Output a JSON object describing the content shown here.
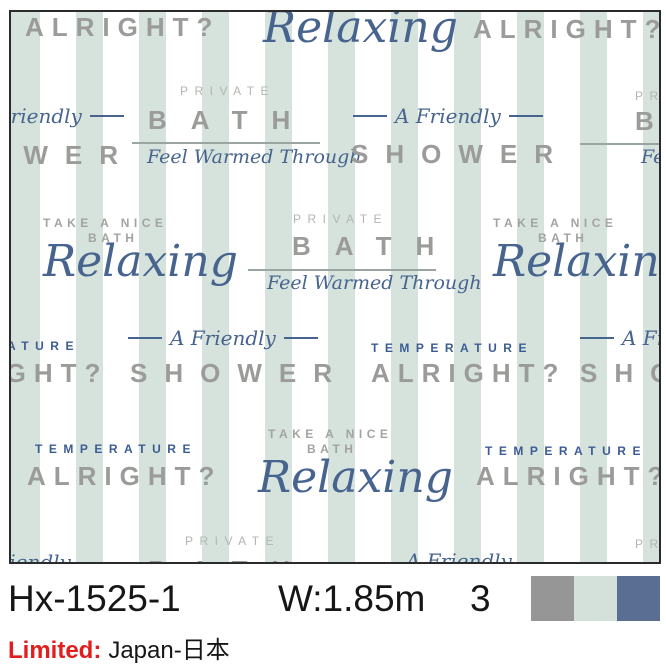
{
  "product": {
    "code": "Hx-1525-1",
    "width_label": "W:1.85m",
    "colorway_count": "3",
    "limited_label": "Limited:",
    "limited_value": "Japan-日本",
    "swatches": [
      {
        "name": "gray",
        "color": "#969696"
      },
      {
        "name": "mint",
        "color": "#d3e1da"
      },
      {
        "name": "blue",
        "color": "#5a6e94"
      }
    ]
  },
  "pattern": {
    "phrases": {
      "alright": "ALRIGHT?",
      "relaxing": "Relaxing",
      "private": "PRIVATE",
      "bath": "BATH",
      "bath_small": "BATH",
      "shower": "SHOWER",
      "take_a_nice": "TAKE A NICE",
      "temperature": "TEMPERATURE",
      "feel_warmed": "Feel Warmed Through",
      "a_friendly": "A Friendly"
    },
    "colors": {
      "stripe_mint": "#d6e3dc",
      "heading_gray": "#9b9b99",
      "private_gray": "#b4b4b2",
      "small_caps_gray": "#a3a3a1",
      "script_blue": "#47648f",
      "temperature_blue": "#3c5c95",
      "panel_border": "#2b2b2b"
    }
  }
}
